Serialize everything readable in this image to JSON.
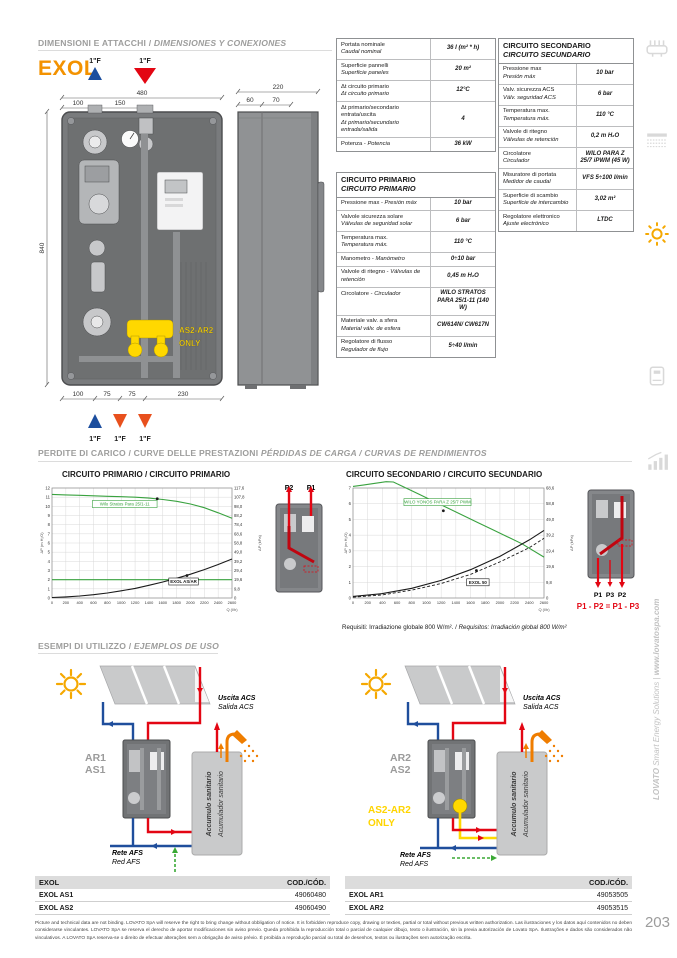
{
  "page": {
    "number": "203",
    "side_text_brand": "LOVATO",
    "side_text_mid": " Smart Energy Solutions | ",
    "side_text_site": "www.lovatospa.com"
  },
  "sections": {
    "dim": {
      "it": "DIMENSIONI E ATTACCHI / ",
      "es": "DIMENSIONES Y CONEXIONES"
    },
    "curves": {
      "it": "PERDITE DI CARICO / CURVE DELLE PRESTAZIONI   ",
      "es": "PÉRDIDAS DE CARGA / CURVAS DE RENDIMIENTOS"
    },
    "usage": {
      "it": "ESEMPI DI UTILIZZO / ",
      "es": "EJEMPLOS DE USO"
    }
  },
  "product": {
    "name": "EXOL"
  },
  "drawing": {
    "front": {
      "w": "480",
      "a": "100",
      "b": "150",
      "h": "840",
      "bottom": [
        "100",
        "75",
        "75",
        "230"
      ],
      "note1": "AS2-AR2",
      "note2": "ONLY"
    },
    "side": {
      "w": "220",
      "a": "60",
      "b": "70"
    },
    "ports_top": [
      "1\"F",
      "1\"F"
    ],
    "ports_bottom": [
      "1\"F",
      "1\"F",
      "1\"F"
    ]
  },
  "spec_table": {
    "rows": [
      {
        "it": "Portata nominale",
        "es": "Caudal nominal",
        "value": "36 l (m² * h)"
      },
      {
        "it": "Superficie pannelli",
        "es": "Superficie paneles",
        "value": "20 m²"
      },
      {
        "it": "Δt circuito primario",
        "es": "Δt circuito primario",
        "value": "12°C"
      },
      {
        "it": "Δt primario/secondario entrata/uscita",
        "es": "Δt primario/secundario entrada/salida",
        "value": "4"
      },
      {
        "it": "Potenza -",
        "es": "Potencia",
        "value": "36 kW",
        "inline": true
      }
    ]
  },
  "primary_table": {
    "title_it": "CIRCUITO PRIMARIO",
    "title_es": "CIRCUITO PRIMARIO",
    "rows": [
      {
        "it": "Pressione max -",
        "es": "Presión máx",
        "value": "10 bar",
        "inline": true
      },
      {
        "it": "Valvole sicurezza solare",
        "es": "Válvulas de seguridad solar",
        "value": "6 bar"
      },
      {
        "it": "Temperatura max.",
        "es": "Temperatura máx.",
        "value": "110 °C"
      },
      {
        "it": "Manometro -",
        "es": "Manómetro",
        "value": "0÷10 bar",
        "inline": true
      },
      {
        "it": "Valvole di ritegno -",
        "es": "Válvulas de retención",
        "value": "0,45 m H₂O",
        "inline": true
      },
      {
        "it": "Circolatore -",
        "es": "Circulador",
        "value": "WILO STRATOS PARA 25/1-11 (140 W)",
        "inline": true
      },
      {
        "it": "Materiale valv. a sfera",
        "es": "Material válv. de esfera",
        "value": "CW614N/ CW617N"
      },
      {
        "it": "Regolatore di flusso",
        "es": "Regulador de flujo",
        "value": "5÷40 l/min"
      }
    ]
  },
  "secondary_table": {
    "title_it": "CIRCUITO SECONDARIO",
    "title_es": "CIRCUITO SECUNDARIO",
    "rows": [
      {
        "it": "Pressione max",
        "es": "Presión máx",
        "value": "10 bar"
      },
      {
        "it": "Valv. sicurezza ACS",
        "es": "Válv. seguridad ACS",
        "value": "6 bar"
      },
      {
        "it": "Temperatura max.",
        "es": "Temperatura máx.",
        "value": "110 °C"
      },
      {
        "it": "Valvole di ritegno",
        "es": "Válvulas de retención",
        "value": "0,2 m H₂O"
      },
      {
        "it": "Circolatore",
        "es": "Circulador",
        "value": "WILO PARA Z 25/7 iPWM (45 W)"
      },
      {
        "it": "Misuratore di portata",
        "es": "Medidor de caudal",
        "value": "VFS 5÷100 l/min"
      },
      {
        "it": "Superficie di scambio",
        "es": "Superficie de intercambio",
        "value": "3,02 m²"
      },
      {
        "it": "Regolatore elettronico",
        "es": "Ajuste electrónico",
        "value": "LTDC"
      }
    ]
  },
  "chart_data": [
    {
      "type": "line",
      "title": "CIRCUITO PRIMARIO / CIRCUITO PRIMARIO",
      "xlabel": "Q (l/h)",
      "ylabel_left": "ΔP (m H₂O)",
      "ylabel_right": "ΔP (kPa)",
      "xlim": [
        0,
        2600
      ],
      "xstep": 200,
      "ylim": [
        0,
        12
      ],
      "ystep": 1,
      "right_ticks": [
        "0",
        "9,8",
        "19,6",
        "29,4",
        "39,2",
        "49,0",
        "58,8",
        "68,6",
        "78,4",
        "88,2",
        "98,0",
        "107,8",
        "117,6"
      ],
      "series": [
        {
          "name": "Wilo Stratos Para 25/1-11",
          "color": "#39a23f",
          "width": 1.1,
          "x": [
            0,
            200,
            400,
            600,
            800,
            1000,
            1200,
            1400,
            1600,
            1800,
            2000,
            2200,
            2400,
            2600
          ],
          "y": [
            11.3,
            11.25,
            11.2,
            11.15,
            11.1,
            11.05,
            11.0,
            10.9,
            10.75,
            10.55,
            10.25,
            9.85,
            9.3,
            8.7
          ]
        },
        {
          "name": "",
          "color": "#39a23f",
          "width": 1.1,
          "x": [
            0,
            2600
          ],
          "y": [
            2,
            2
          ]
        },
        {
          "name": "EXOL AS/AR",
          "color": "#1a1a1a",
          "width": 1.1,
          "x": [
            0,
            200,
            400,
            600,
            800,
            1000,
            1200,
            1400,
            1600,
            1800,
            2000,
            2200,
            2400,
            2600
          ],
          "y": [
            0.05,
            0.12,
            0.22,
            0.36,
            0.55,
            0.78,
            1.05,
            1.38,
            1.75,
            2.15,
            2.6,
            3.1,
            3.65,
            4.25
          ]
        }
      ],
      "annotations": [
        {
          "text": "Wilo Stratos Para 25/1-11",
          "color": "#39a23f",
          "box": "#39a23f",
          "x": 1050,
          "y": 10.25,
          "dot": [
            1520,
            10.82
          ]
        },
        {
          "text": "EXOL AS/AR",
          "color": "#1a1a1a",
          "box": "#1a1a1a",
          "bold": true,
          "x": 1900,
          "y": 1.8,
          "dot": [
            1950,
            2.45
          ]
        }
      ]
    },
    {
      "type": "line",
      "title": "CIRCUITO SECONDARIO / CIRCUITO SECUNDARIO",
      "xlabel": "Q (l/h)",
      "ylabel_left": "ΔP (m H₂O)",
      "ylabel_right": "ΔP (kPa)",
      "xlim": [
        0,
        2600
      ],
      "xstep": 200,
      "ylim": [
        0,
        7
      ],
      "ystep": 1,
      "right_ticks": [
        "0",
        "9,8",
        "19,6",
        "29,4",
        "39,2",
        "49,0",
        "58,8",
        "68,6"
      ],
      "series": [
        {
          "name": "WILO YONOS PARA Z 25/7 PWM",
          "color": "#39a23f",
          "width": 1.1,
          "x": [
            0,
            150,
            300,
            450,
            550,
            700,
            900,
            1100,
            1300,
            1500,
            1700,
            1900,
            2100,
            2300,
            2600
          ],
          "y": [
            7.1,
            7.2,
            7.3,
            7.4,
            7.38,
            7.05,
            6.6,
            6.15,
            5.7,
            5.25,
            4.8,
            4.35,
            3.9,
            3.45,
            2.6
          ]
        },
        {
          "name": "EXOL 50",
          "color": "#1a1a1a",
          "width": 1.1,
          "x": [
            0,
            400,
            800,
            1200,
            1600,
            2000,
            2400,
            2600
          ],
          "y": [
            0.1,
            0.28,
            0.62,
            1.12,
            1.8,
            2.65,
            3.7,
            4.3
          ]
        },
        {
          "name": "",
          "color": "#1a1a1a",
          "width": 0.9,
          "dash": "3,2",
          "x": [
            0,
            400,
            800,
            1200,
            1600,
            2000,
            2400,
            2600
          ],
          "y": [
            0.05,
            0.2,
            0.5,
            0.92,
            1.5,
            2.3,
            3.2,
            3.8
          ]
        }
      ],
      "annotations": [
        {
          "text": "WILO YONOS PARA Z 25/7 PWM",
          "color": "#39a23f",
          "box": "#39a23f",
          "x": 1150,
          "y": 6.1,
          "dot": [
            1230,
            5.55
          ]
        },
        {
          "text": "EXOL 50",
          "color": "#1a1a1a",
          "box": "#1a1a1a",
          "bold": true,
          "x": 1700,
          "y": 1.0,
          "dot": [
            1680,
            1.75
          ]
        }
      ]
    }
  ],
  "mini1": {
    "labels": [
      "P2",
      "P1"
    ]
  },
  "mini2": {
    "labels": [
      "P1",
      "P3",
      "P2"
    ],
    "equation": "P1 - P2 = P1 - P3"
  },
  "requisiti": {
    "it": "Requisiti: Irradiazione globale 800 W/m².  /  ",
    "es": "Requisitos: Irradiación global 800 W/m²"
  },
  "diagram_left": {
    "unit1": "AR1",
    "unit2": "AS1",
    "out_it": "Uscita ACS",
    "out_es": "Salida ACS",
    "tank_it": "Accumulo sanitario",
    "tank_es": "Acumulador sanitario",
    "net_it": "Rete AFS",
    "net_es": "Red AFS"
  },
  "diagram_right": {
    "unit1": "AR2",
    "unit2": "AS2",
    "note1": "AS2-AR2",
    "note2": "ONLY",
    "out_it": "Uscita ACS",
    "out_es": "Salida ACS",
    "tank_it": "Accumulo sanitario",
    "tank_es": "Acumulador sanitario",
    "net_it": "Rete AFS",
    "net_es": "Red AFS"
  },
  "code_tables": [
    {
      "header": "EXOL",
      "code_header": "COD./CÓD.",
      "rows": [
        {
          "name": "EXOL AS1",
          "code": "49060480"
        },
        {
          "name": "EXOL AS2",
          "code": "49060490"
        }
      ]
    },
    {
      "header": "",
      "code_header": "COD./CÓD.",
      "rows": [
        {
          "name": "EXOL AR1",
          "code": "49053505"
        },
        {
          "name": "EXOL AR2",
          "code": "49053515"
        }
      ]
    }
  ],
  "legal": "Picture and technical data are not binding. LOVATO SpA will reserve the right to bring change without obbligation of notice. It is forbidden reproduce copy, drawing or texties, partial or total without previous written authorization. Las ilustraciones y los datos aquí contenidos no deben considerarse vinculantes. LOVATO SpA se reserva el derecho de aportar modificaciones sin aviso previo. Queda prohibida la reproducción total o parcial de cualquier dibujo, texto o ilustración, sin la previa autorización de Lovato SpA. Ilustrações e dados são considerados não vinculativos. A LOVATO SpA reserva-se o direito de efectuar alterações sem a obrigação de aviso prévio. É proibida a reprodução parcial ou total de desenhos, textos ou ilustrações sem autorização escrita."
}
